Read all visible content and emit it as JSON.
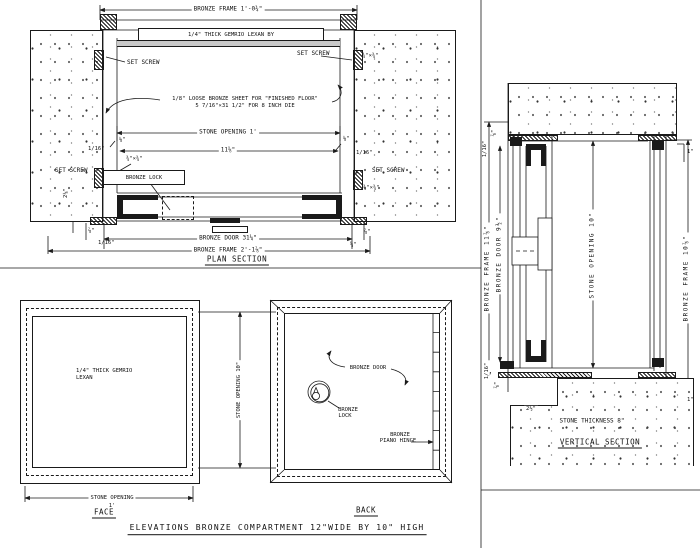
{
  "page": {
    "title_block": "ELEVATIONS BRONZE COMPARTMENT 12\"WIDE BY 10\" HIGH"
  },
  "plan": {
    "title": "PLAN SECTION",
    "frame_top_dim": "BRONZE FRAME 1'-0¾\"",
    "lexan_note": "1/4\" THICK GEMRIO LEXAN BY",
    "set_screw": "SET SCREW",
    "lug_dim": "¾\"×¾\"",
    "sheet_note_line1": "1/8\" LOOSE BRONZE SHEET FOR \"FINISHED FLOOR\"",
    "sheet_note_line2": "5 7/16\"×31 1/2\" FOR 8 INCH DIE",
    "stone_opening_dim": "STONE OPENING 1'",
    "inner_dim": "11⅝\"",
    "eighth_dim": "⅛\"",
    "sixteenth_dim": "1/16\"",
    "lock_label": "BRONZE LOCK",
    "side_dim": "2⅛\"",
    "seven_eighth_dim": "⅞\"",
    "five_eighth_dim": "⅝\"",
    "door_dim": "BRONZE DOOR 31¼\"",
    "frame_bottom_dim": "BRONZE FRAME 2'-1⅞\""
  },
  "vertical_section": {
    "title": "VERTICAL SECTION",
    "frame_left_dim": "BRONZE FRAME 11⅞\"",
    "door_dim": "BRONZE DOOR 9½\"",
    "stone_opening_dim": "STONE OPENING 10\"",
    "frame_right_dim": "BRONZE FRAME 10⅞\"",
    "sixteenth_dim": "1/16\"",
    "seven_eighth_dim": "⅞\"",
    "one_inch_dim": "1\"",
    "ledge_dim": "2½\"",
    "stone_thickness": "STONE THICKNESS 8\""
  },
  "elevations": {
    "face": {
      "title": "FACE",
      "lexan_line1": "1/4\" THICK GEMRIO",
      "lexan_line2": "LEXAN",
      "opening_dim_line1": "STONE OPENING",
      "opening_dim_line2": "1'"
    },
    "height_dim": "STONE OPENING 10\"",
    "back": {
      "title": "BACK",
      "door_label": "BRONZE DOOR",
      "lock_label_line1": "BRONZE",
      "lock_label_line2": "LOCK",
      "hinge_label_line1": "BRONZE",
      "hinge_label_line2": "PIANO HINGE"
    }
  }
}
